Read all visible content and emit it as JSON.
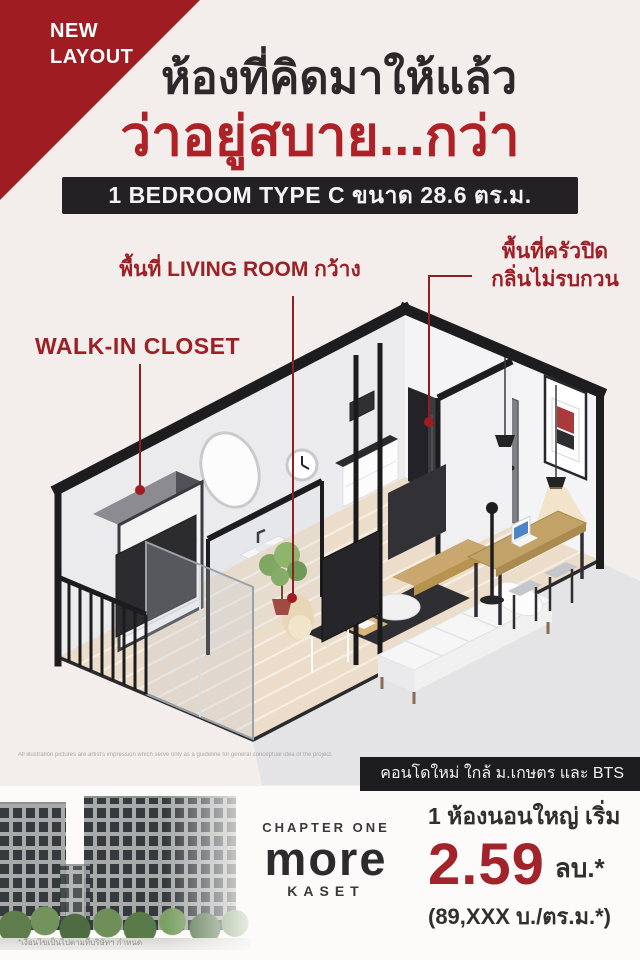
{
  "badge": {
    "line1": "NEW",
    "line2": "LAYOUT"
  },
  "headline": {
    "line1": "ห้องที่คิดมาให้แล้ว",
    "line2": "ว่าอยู่สบาย...กว่า"
  },
  "unit_banner": "1 BEDROOM TYPE C ขนาด 28.6 ตร.ม.",
  "plan_labels": {
    "living": "พื้นที่ LIVING ROOM กว้าง",
    "kitchen_line1": "พื้นที่ครัวปิด",
    "kitchen_line2": "กลิ่นไม่รบกวน",
    "walkin": "WALK-IN CLOSET"
  },
  "plan_disclaimer": "All illustration pictures are artist's impression which serve only as a guideline for general conceptual idea of the project.",
  "location_banner": "คอนโดใหม่ ใกล้ ม.เกษตร และ BTS",
  "brand": {
    "line1": "CHAPTER ONE",
    "line2": "more",
    "line3": "KASET"
  },
  "pricing": {
    "intro": "1 ห้องนอนใหญ่ เริ่ม",
    "price": "2.59",
    "unit": "ลบ.*",
    "per_sqm": "(89,XXX บ./ตร.ม.*)"
  },
  "footnote": "*เงื่อนไขเป็นไปตามที่บริษัทฯ กำหนด",
  "colors": {
    "poster_bg": "#f3eeeb",
    "accent_red": "#9e1c22",
    "headline_red": "#ae2127",
    "label_red": "#9c2025",
    "price_red": "#a2242a",
    "banner_dark": "#232124"
  }
}
